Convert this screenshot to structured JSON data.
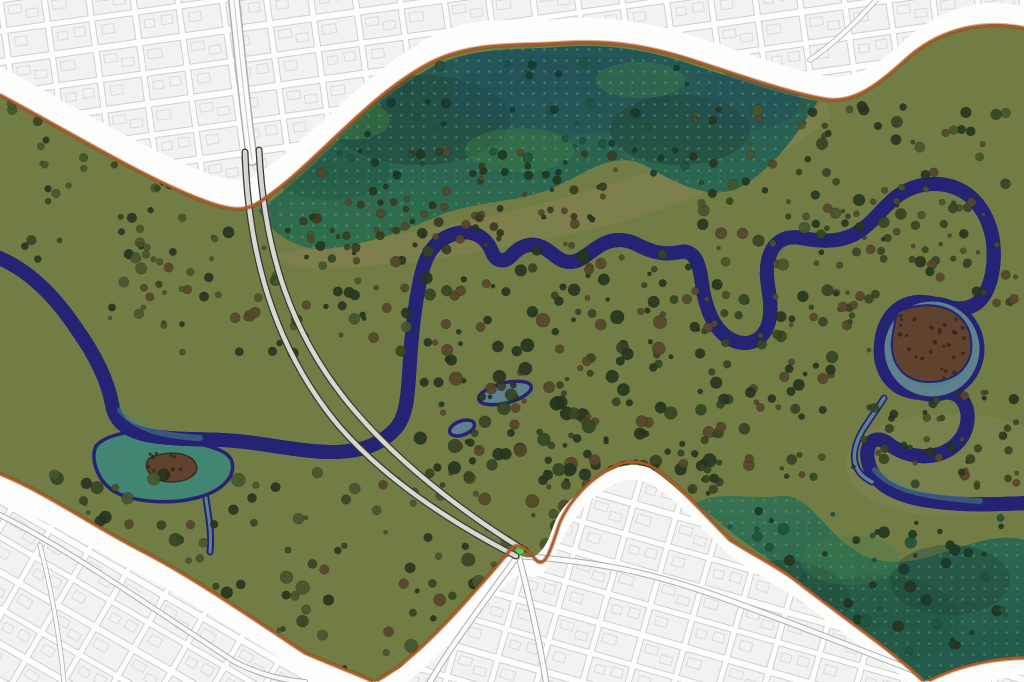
{
  "map": {
    "name": "river-park-masterplan",
    "width": 1024,
    "height": 682,
    "regions": [
      {
        "id": "city-fabric-north",
        "kind": "urban-blocks"
      },
      {
        "id": "city-fabric-south",
        "kind": "urban-blocks"
      },
      {
        "id": "ring-road-band",
        "kind": "road-corridor"
      },
      {
        "id": "park-meadow",
        "kind": "grassland"
      },
      {
        "id": "wetland-north",
        "kind": "wetland"
      },
      {
        "id": "wetland-southeast",
        "kind": "wetland"
      },
      {
        "id": "river",
        "kind": "watercourse"
      },
      {
        "id": "marsh-pond-west",
        "kind": "pond"
      },
      {
        "id": "scrub-island-east",
        "kind": "bare-scrub"
      },
      {
        "id": "footpaths",
        "kind": "twin-paths"
      }
    ]
  },
  "colors": {
    "band": "#fdfdfc",
    "cityBlock": "#f2f2f0",
    "cityLine": "#c5c5c3",
    "cityRoad": "#fbfbfa",
    "cityRoadCase": "#aeaeac",
    "boundary": "#b25a24",
    "boundaryShadow": "#6f3410",
    "meadow": "#8f9d5a",
    "tan": "#aaa76b",
    "tree": "#455a2f",
    "treeDark": "#31452a",
    "treeLight": "#5c6e3c",
    "shrubBrown": "#6f5b38",
    "oliveDark": "#4d4c28",
    "scrub": "#7b563c",
    "scrubDark": "#4a3524",
    "wetTop1": "#2e6d74",
    "wetTop2": "#3f8f63",
    "wetBR1": "#2f7468",
    "wetBR2": "#49956b",
    "wetDark": "#27584b",
    "wetBlue": "#2c6378",
    "wetLightGreen": "#4f9d58",
    "wetTree": "#1f4a3a",
    "wetTree2": "#2b6b52",
    "wetDot": "#74d9a6",
    "riverBorder": "#2f2d99",
    "riverInner": "#8d87da",
    "water": "#7ba5ba",
    "waterTeal": "#5ea8ab",
    "pond": "#55ab96",
    "noise": "#1c2410",
    "path": "#d8d8d2",
    "pathEdge": "#3a3a32",
    "junctionGreen": "#53d153"
  },
  "vegetation": {
    "seed": 7,
    "clusters": [
      {
        "name": "top-left-corner",
        "x": 10,
        "y": 100,
        "w": 200,
        "h": 160,
        "count": 40,
        "rmin": 2,
        "rmax": 5,
        "palette": [
          "tree",
          "treeDark",
          "treeLight"
        ]
      },
      {
        "name": "left-band",
        "x": 110,
        "y": 225,
        "w": 320,
        "h": 130,
        "count": 80,
        "rmin": 2,
        "rmax": 6,
        "palette": [
          "tree",
          "treeDark",
          "shrubBrown",
          "treeLight"
        ]
      },
      {
        "name": "center-dense",
        "x": 420,
        "y": 250,
        "w": 300,
        "h": 230,
        "count": 170,
        "rmin": 2,
        "rmax": 7,
        "palette": [
          "treeDark",
          "tree",
          "shrubBrown",
          "treeDark"
        ]
      },
      {
        "name": "center-east",
        "x": 700,
        "y": 290,
        "w": 170,
        "h": 190,
        "count": 70,
        "rmin": 2,
        "rmax": 6,
        "palette": [
          "tree",
          "treeDark",
          "shrubBrown"
        ]
      },
      {
        "name": "top-right-meadow",
        "x": 690,
        "y": 105,
        "w": 320,
        "h": 160,
        "count": 90,
        "rmin": 2,
        "rmax": 6,
        "palette": [
          "tree",
          "treeDark",
          "treeLight",
          "shrubBrown"
        ]
      },
      {
        "name": "bottom-band",
        "x": 50,
        "y": 470,
        "w": 580,
        "h": 200,
        "count": 160,
        "rmin": 2,
        "rmax": 7,
        "palette": [
          "treeDark",
          "tree",
          "treeLight",
          "shrubBrown"
        ]
      },
      {
        "name": "wetland-top-edge",
        "x": 280,
        "y": 150,
        "w": 340,
        "h": 100,
        "count": 80,
        "rmin": 2,
        "rmax": 5,
        "palette": [
          "shrubBrown",
          "oliveDark",
          "treeDark"
        ]
      },
      {
        "name": "wetland-top-interior",
        "x": 270,
        "y": 60,
        "w": 440,
        "h": 120,
        "count": 60,
        "rmin": 2,
        "rmax": 5,
        "palette": [
          "wetTree",
          "wetTree2"
        ]
      },
      {
        "name": "wetland-se-interior",
        "x": 720,
        "y": 510,
        "w": 290,
        "h": 150,
        "count": 70,
        "rmin": 2,
        "rmax": 6,
        "palette": [
          "wetTree",
          "treeDark",
          "wetTree2"
        ]
      },
      {
        "name": "east-edge",
        "x": 860,
        "y": 380,
        "w": 160,
        "h": 110,
        "count": 45,
        "rmin": 2,
        "rmax": 5,
        "palette": [
          "tree",
          "treeDark",
          "shrubBrown"
        ]
      },
      {
        "name": "se-meadow",
        "x": 545,
        "y": 430,
        "w": 175,
        "h": 90,
        "count": 40,
        "rmin": 2,
        "rmax": 5,
        "palette": [
          "tree",
          "treeDark"
        ]
      },
      {
        "name": "mid-right-scatter",
        "x": 820,
        "y": 200,
        "w": 200,
        "h": 110,
        "count": 50,
        "rmin": 2,
        "rmax": 5,
        "palette": [
          "tree",
          "shrubBrown",
          "treeDark"
        ]
      },
      {
        "name": "scrub-island-speckle",
        "x": 898,
        "y": 312,
        "w": 70,
        "h": 66,
        "count": 28,
        "rmin": 1,
        "rmax": 2,
        "palette": [
          "scrubDark"
        ]
      },
      {
        "name": "pond-island-speckle",
        "x": 146,
        "y": 452,
        "w": 54,
        "h": 28,
        "count": 12,
        "rmin": 1,
        "rmax": 2,
        "palette": [
          "scrubDark"
        ]
      }
    ]
  }
}
